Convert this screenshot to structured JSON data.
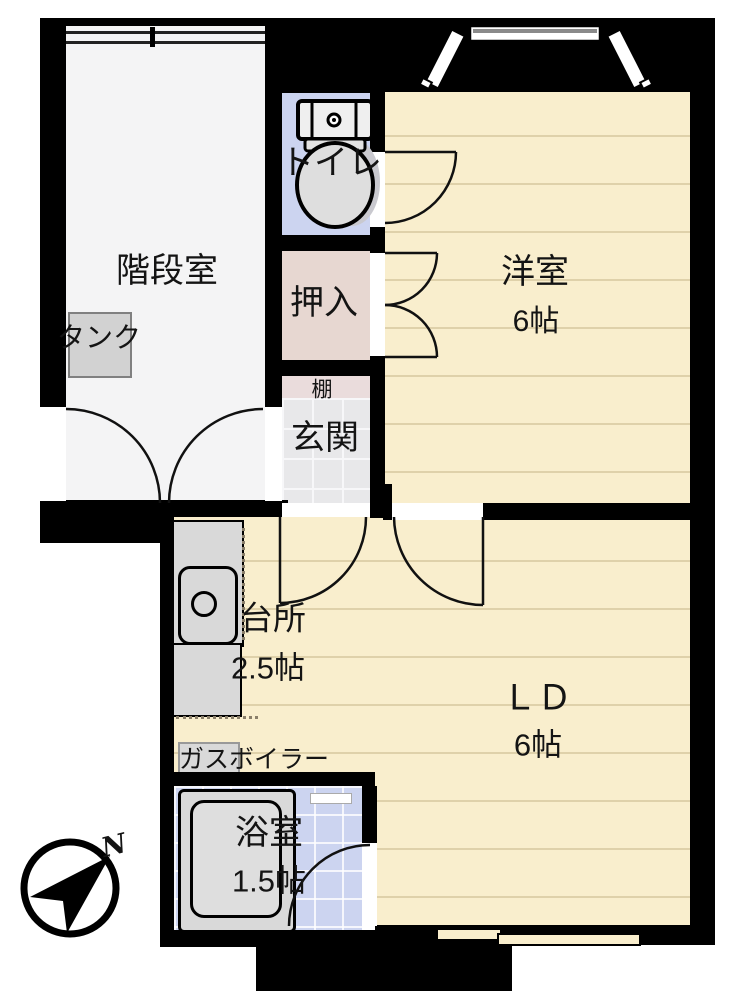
{
  "plan": {
    "rooms": {
      "stairwell": {
        "label": "階段室"
      },
      "toilet": {
        "label": "トイレ"
      },
      "closet": {
        "label": "押入"
      },
      "shelf": {
        "label": "棚"
      },
      "entrance": {
        "label": "玄関"
      },
      "western_room": {
        "label": "洋室",
        "size": "6帖"
      },
      "kitchen": {
        "label": "台所",
        "size": "2.5帖"
      },
      "living_dining": {
        "label": "ＬＤ",
        "size": "6帖"
      },
      "bathroom": {
        "label": "浴室",
        "size": "1.5帖"
      }
    },
    "fixtures": {
      "tank": {
        "label": "タンク"
      },
      "gas_boiler": {
        "label": "ガスボイラー"
      }
    },
    "compass": {
      "north_label": "N"
    },
    "colors": {
      "wall": "#000000",
      "tatami_cream": "#f9eecd",
      "tatami_line": "#dfd1aa",
      "tile_blue": "#ccd4f0",
      "closet_pink": "#e7d7d1",
      "shelf_pink": "#eadcdc",
      "entry_gray": "#e8e8ea",
      "stairwell_gray": "#f4f4f5",
      "fixture_gray": "#d9d9d9"
    }
  }
}
